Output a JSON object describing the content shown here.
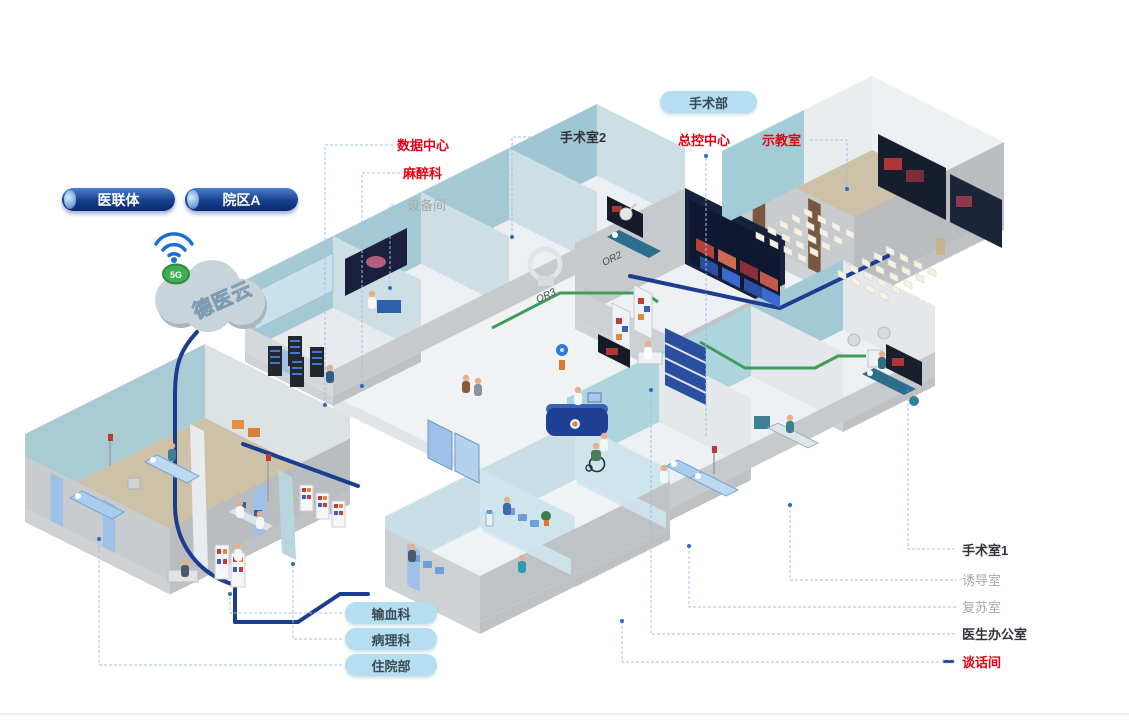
{
  "cloud": {
    "label": "德医云",
    "badge": "5G"
  },
  "pills": {
    "consortium": "医联体",
    "campus_a": "院区A",
    "surgery_dept": "手术部",
    "blood": "输血科",
    "pathology": "病理科",
    "inpatient": "住院部"
  },
  "callouts": {
    "data_center": "数据中心",
    "anesthesia": "麻醉科",
    "equipment_room": "设备间",
    "or_2": "手术室2",
    "master_control": "总控中心",
    "demo_room": "示教室",
    "or_1": "手术室1",
    "induction_room": "诱导室",
    "recovery_room": "复苏室",
    "doctor_office": "医生办公室",
    "talk_room": "谈话间"
  },
  "room_door_labels": {
    "or2": "OR2",
    "or3": "OR3"
  },
  "colors": {
    "callout_red": "#e60012",
    "callout_dark": "#33333b",
    "callout_gray": "#a8a8a8",
    "pill_light_blue": "#b5def0",
    "pill_navy": "#17418f",
    "cable_navy": "#1b3d8f",
    "cable_green": "#3f9d5a",
    "leader_blue": "#9ec0e4",
    "wall_teal": "#a9ccd4",
    "floor_tan": "#cdc2a7",
    "badge_green": "#3fae52"
  }
}
